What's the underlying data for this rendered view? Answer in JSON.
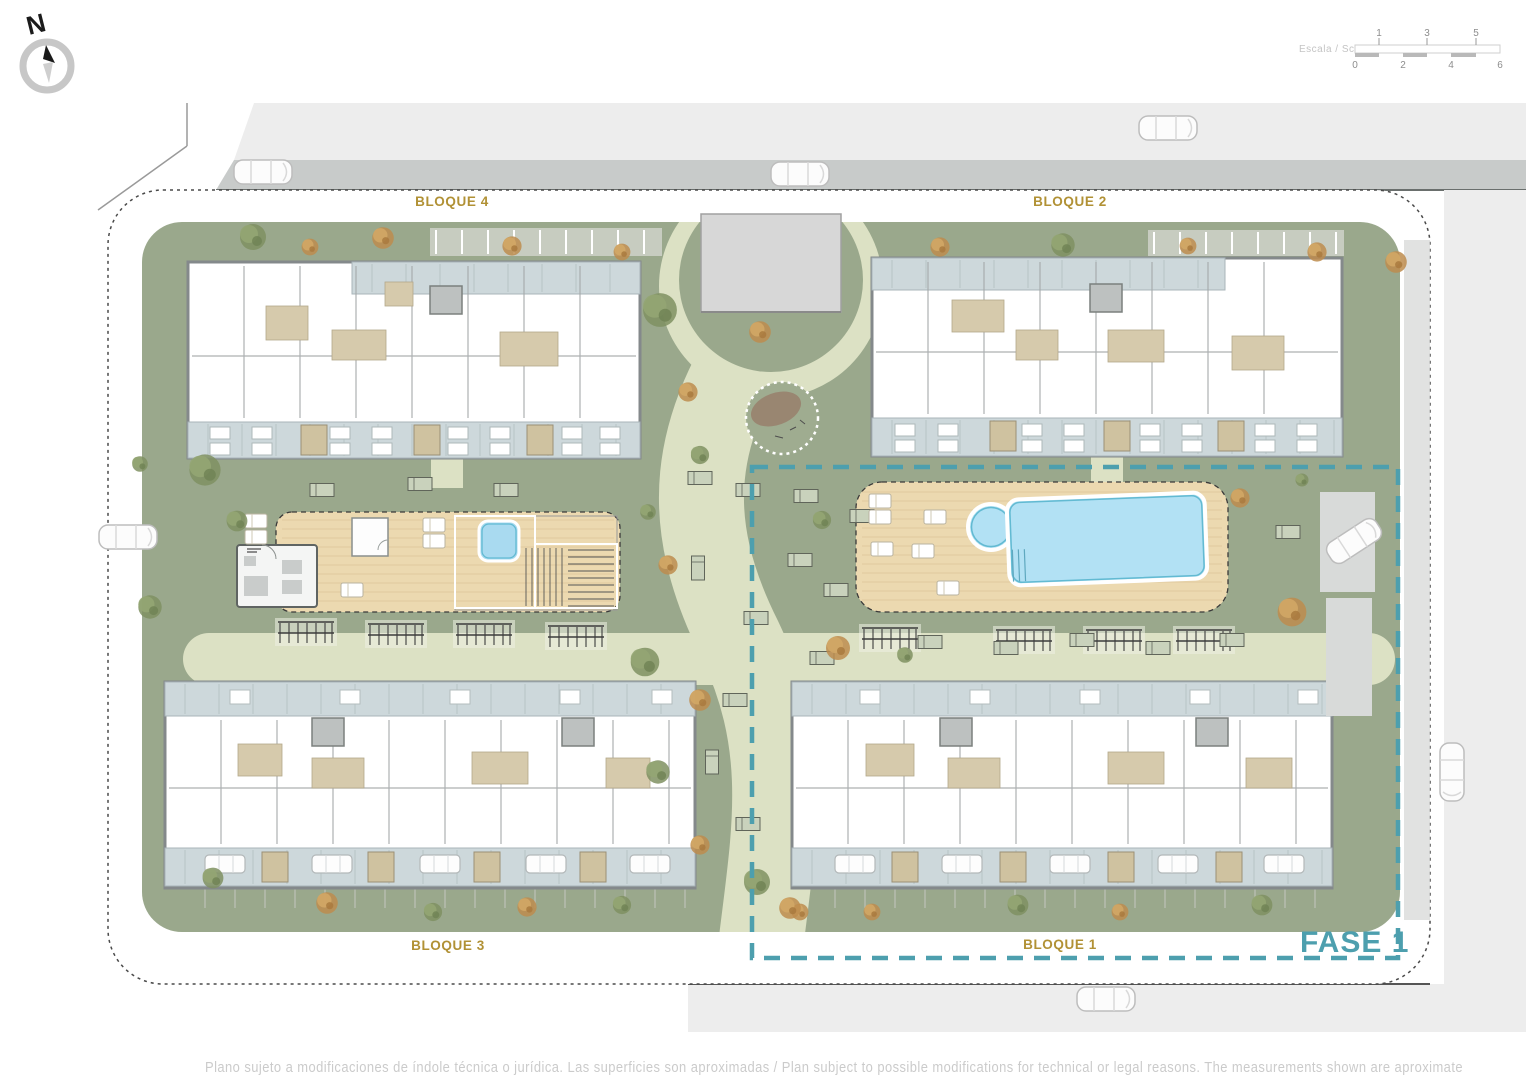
{
  "compass": {
    "north_label": "N"
  },
  "scale_bar": {
    "label": "Escala / Scale",
    "top_numbers": [
      "1",
      "3",
      "5"
    ],
    "bottom_numbers": [
      "0",
      "2",
      "4",
      "6"
    ]
  },
  "block_labels": {
    "bloque_4": "BLOQUE 4",
    "bloque_2": "BLOQUE 2",
    "bloque_3": "BLOQUE 3",
    "bloque_1": "BLOQUE 1"
  },
  "phase_label": "FASE 1",
  "disclaimer": "Plano sujeto a modificaciones de índole técnica o jurídica. Las superficies son aproximadas / Plan subject to possible modifications for technical or legal reasons. The measurements  shown are aproximate",
  "colors": {
    "block_label_gold": "#b19135",
    "phase_teal": "#4d9fae",
    "lawn_green": "#9aa88c",
    "path_pale": "#dce1c4",
    "deck_wood": "#ecd9b0",
    "pool_blue": "#b2e1f4",
    "terrace_blue_gray": "#cdd8db",
    "road_dark": "#c8cbca",
    "road_light": "#ededed"
  }
}
